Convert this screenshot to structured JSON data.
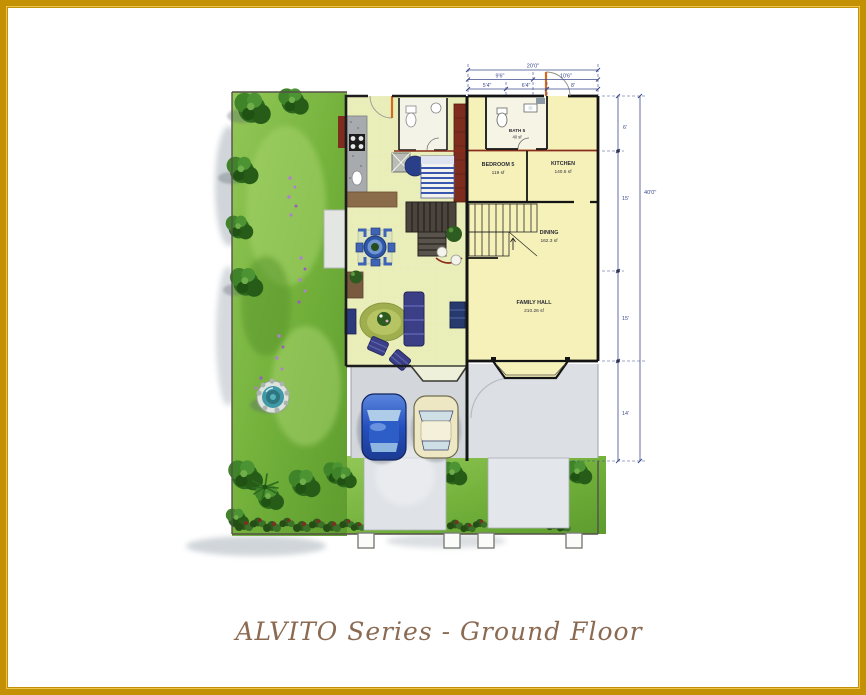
{
  "caption": {
    "text": "ALVITO Series - Ground Floor"
  },
  "rooms": {
    "bath5": {
      "name": "BATH 5",
      "area": "40 sf"
    },
    "bedroom5": {
      "name": "BEDROOM 5",
      "area": "119 sf"
    },
    "kitchen": {
      "name": "KITCHEN",
      "area": "140.5 sf"
    },
    "dining": {
      "name": "DINING",
      "area": "162.3 sf"
    },
    "family_hall": {
      "name": "FAMILY HALL",
      "area": "210.26 sf"
    }
  },
  "dim_top": [
    "20'0\"",
    "9'6\"",
    "10'6\"",
    "5'4\"",
    "6'4\"",
    "8'"
  ],
  "dim_right": [
    "6'",
    "15'",
    "15'",
    "14'",
    "40'0\""
  ],
  "colors": {
    "frame_gold": "#c59104",
    "plan_yellow": "#f5f1b8",
    "show_unit_floor": "#e9edb8",
    "lawn_green": "#7dbb45",
    "tree_green": "#2d6a1e",
    "wall_black": "#141414",
    "dimension_navy": "#3d4a8c",
    "accent_maroon": "#8a2c1c",
    "car_blue": "#2d5ec8",
    "car_cream": "#ede7c4",
    "caption_brown": "#8b6a52",
    "driveway_gray": "#dfe2e6"
  }
}
